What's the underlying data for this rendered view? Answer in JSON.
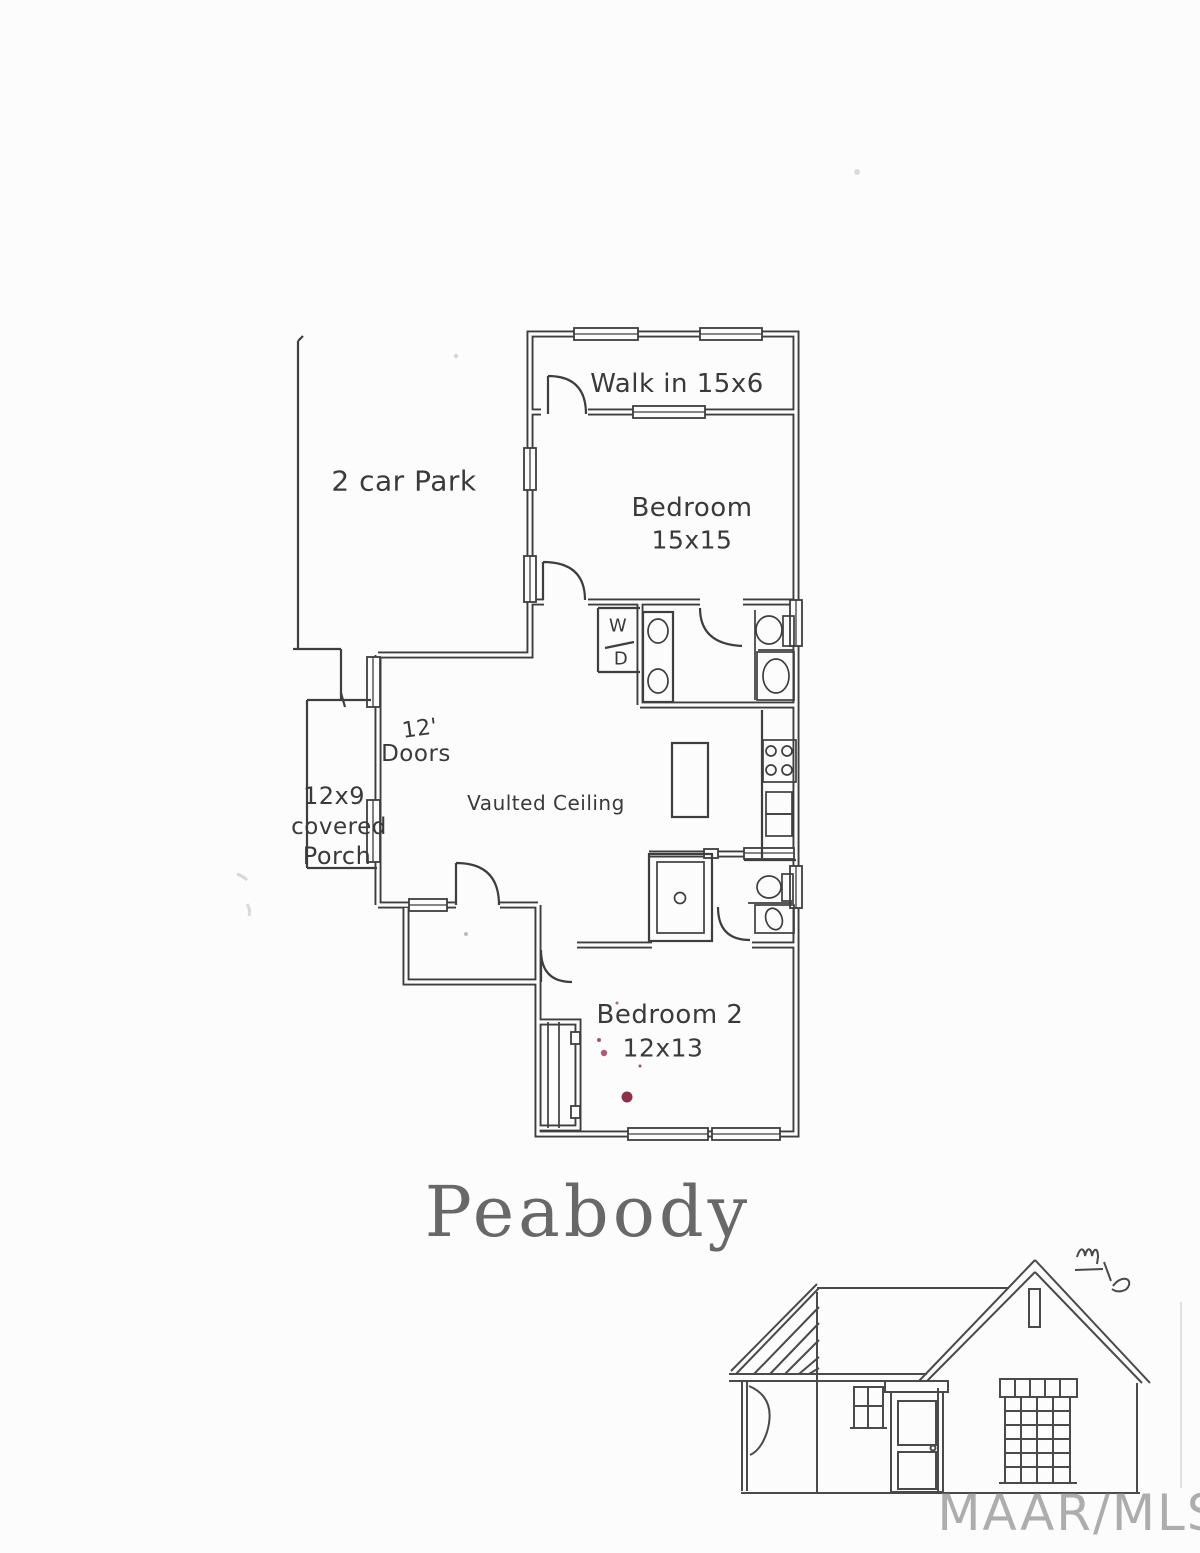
{
  "page": {
    "background": "#fcfcfc"
  },
  "plan": {
    "labels": {
      "walk_in": "Walk in 15x6",
      "car_park": "2 car Park",
      "bedroom1_name": "Bedroom",
      "bedroom1_dims": "15x15",
      "washer_dryer_top": "W",
      "washer_dryer_bottom": "D",
      "doors_height": "12'",
      "doors_word": "Doors",
      "vaulted_ceiling": "Vaulted Ceiling",
      "porch_dims": "12x9",
      "porch_word1": "covered",
      "porch_word2": "Porch",
      "bedroom2_name": "Bedroom 2",
      "bedroom2_dims": "12x13"
    }
  },
  "title": "Peabody",
  "watermark": "MAAR/MLS",
  "colors": {
    "ink": "#3e3e3e",
    "title_gray": "#686868",
    "watermark_gray": "#8f8f8f",
    "stain_red": "#8e3048"
  }
}
